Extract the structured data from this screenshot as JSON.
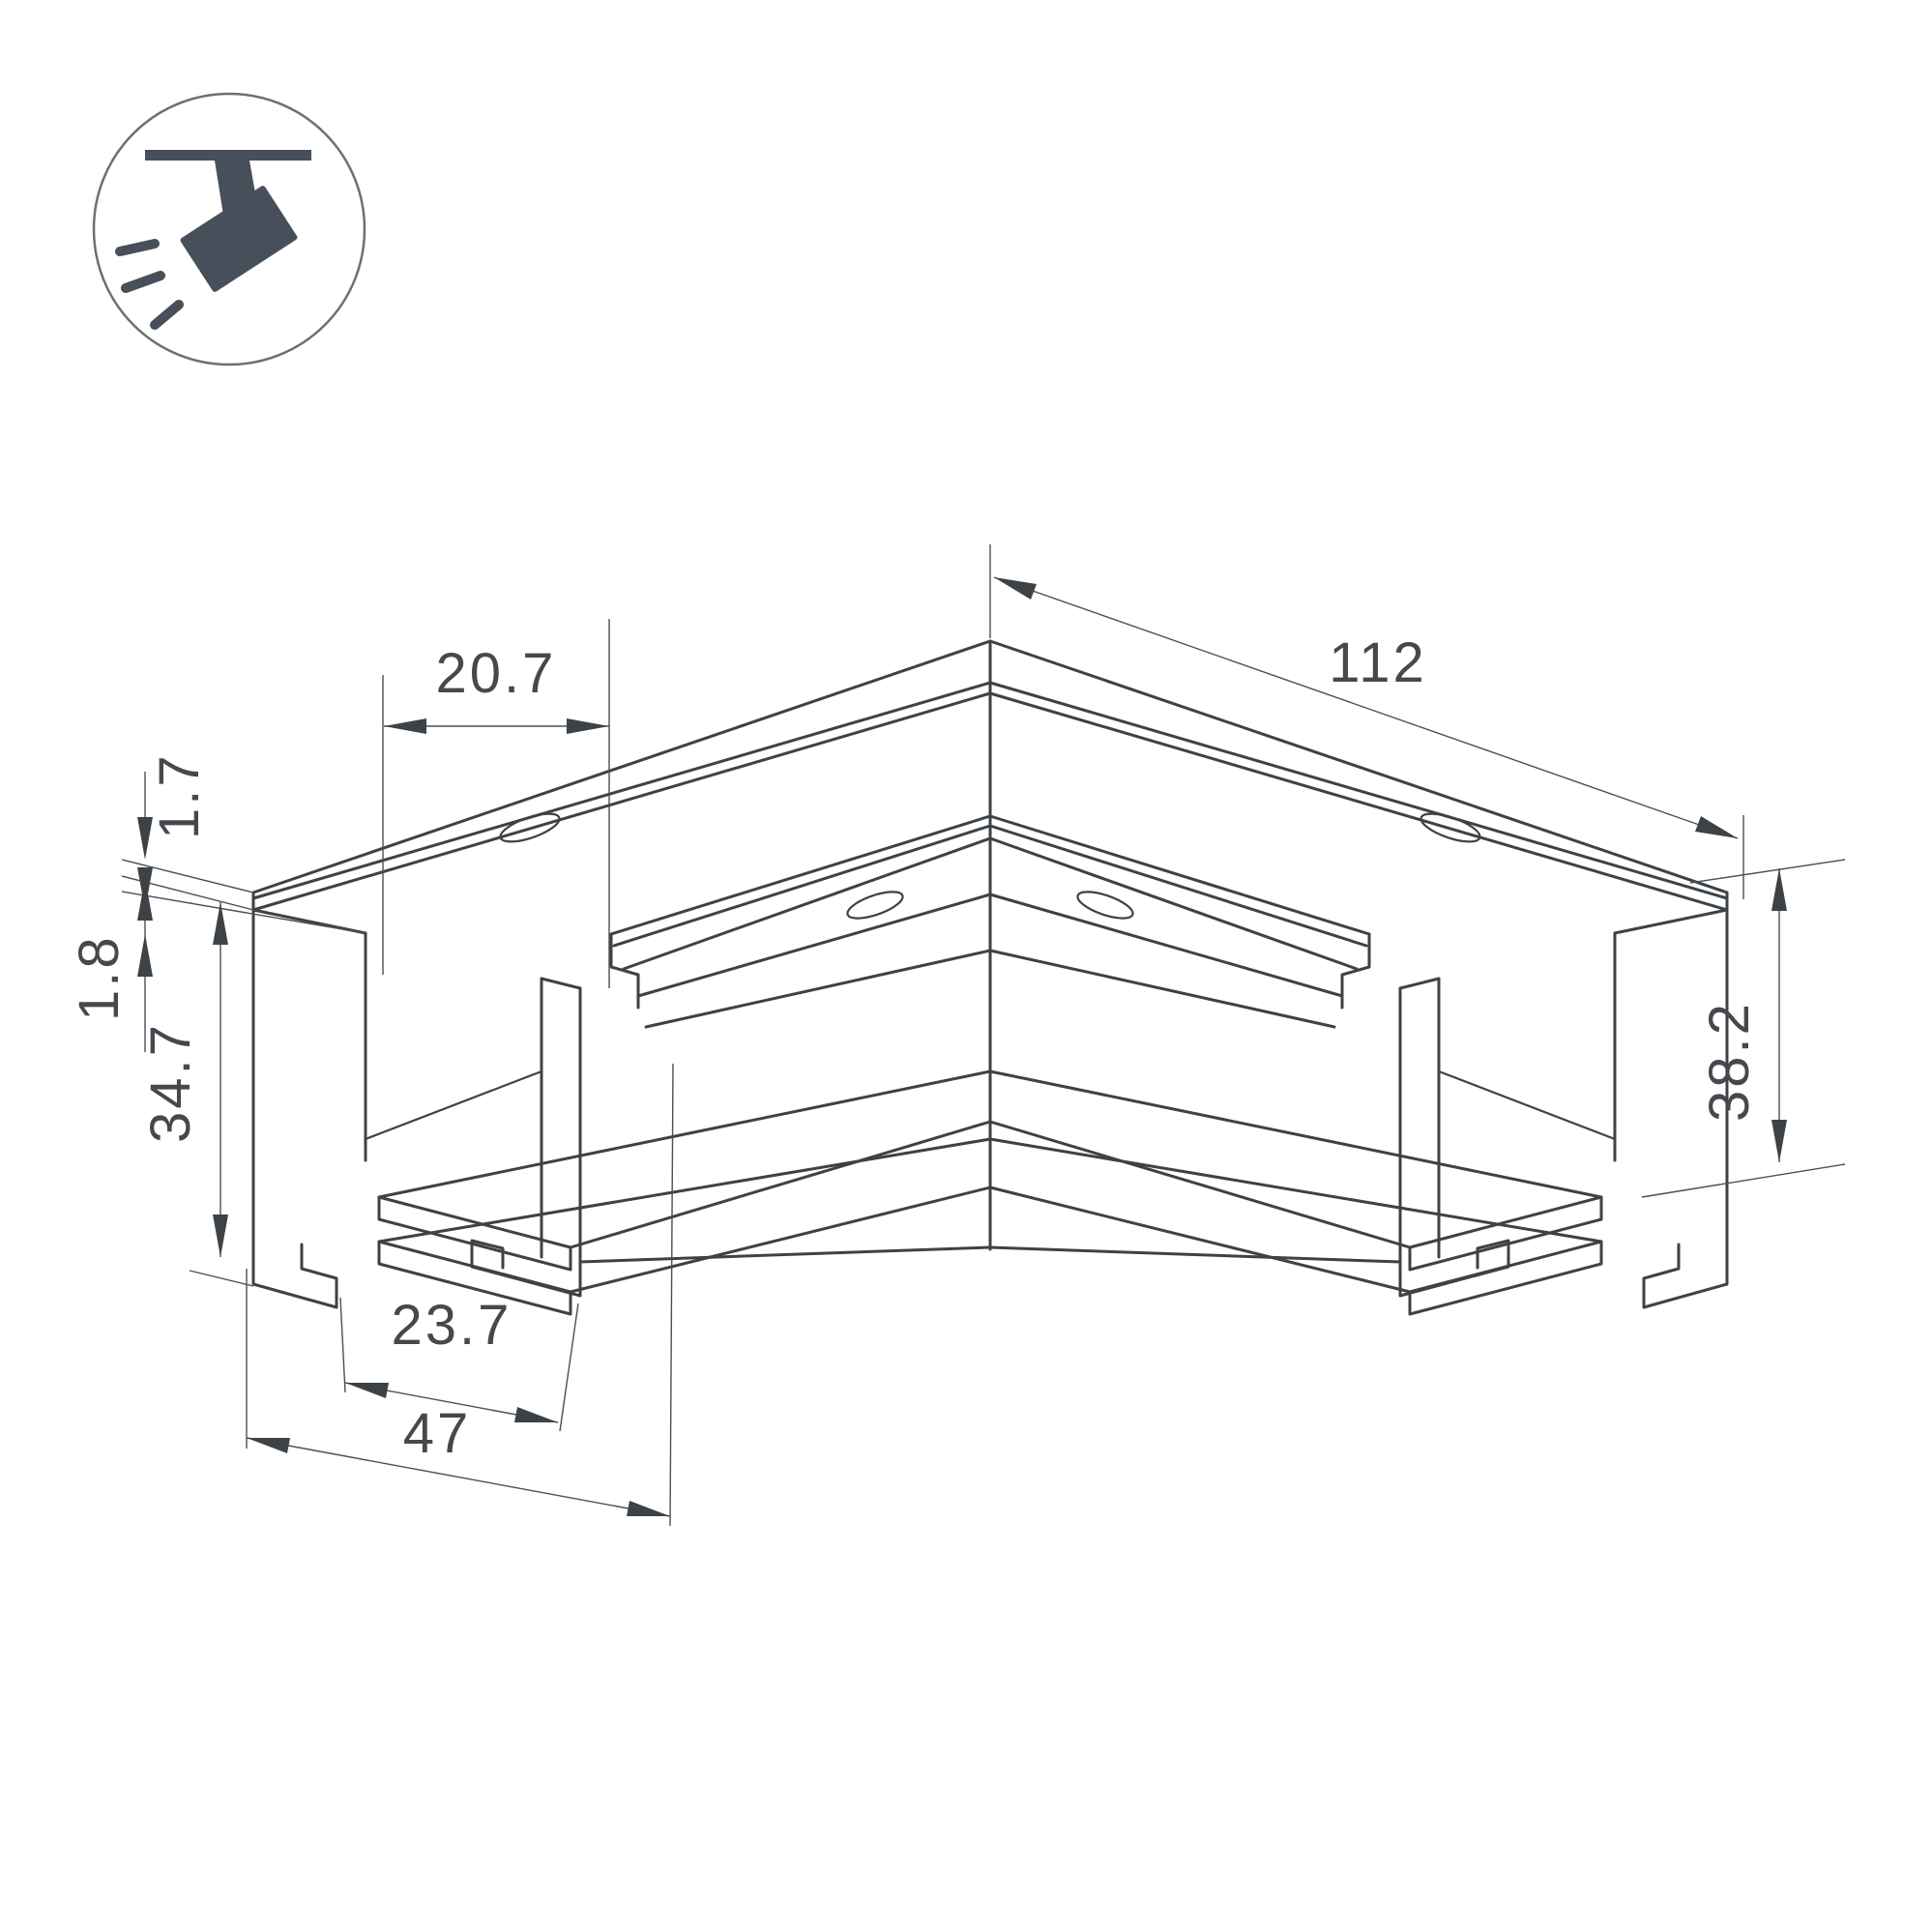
{
  "icon": {
    "name": "recessed-track-spotlight",
    "circle_color": "#6a7076",
    "glyph_color": "#47505a"
  },
  "drawing": {
    "subject": "corner-connector-magnetic-track-profile",
    "dimensions": {
      "top_inset": "20.7",
      "flange_thickness": "1.7",
      "ledge_offset": "1.8",
      "body_height": "34.7",
      "track_width": "23.7",
      "base_width": "47",
      "arm_length": "112",
      "total_height": "38.2"
    }
  },
  "colors": {
    "line": "#3d4247",
    "dimension_text": "#45494e",
    "background": "#ffffff"
  }
}
